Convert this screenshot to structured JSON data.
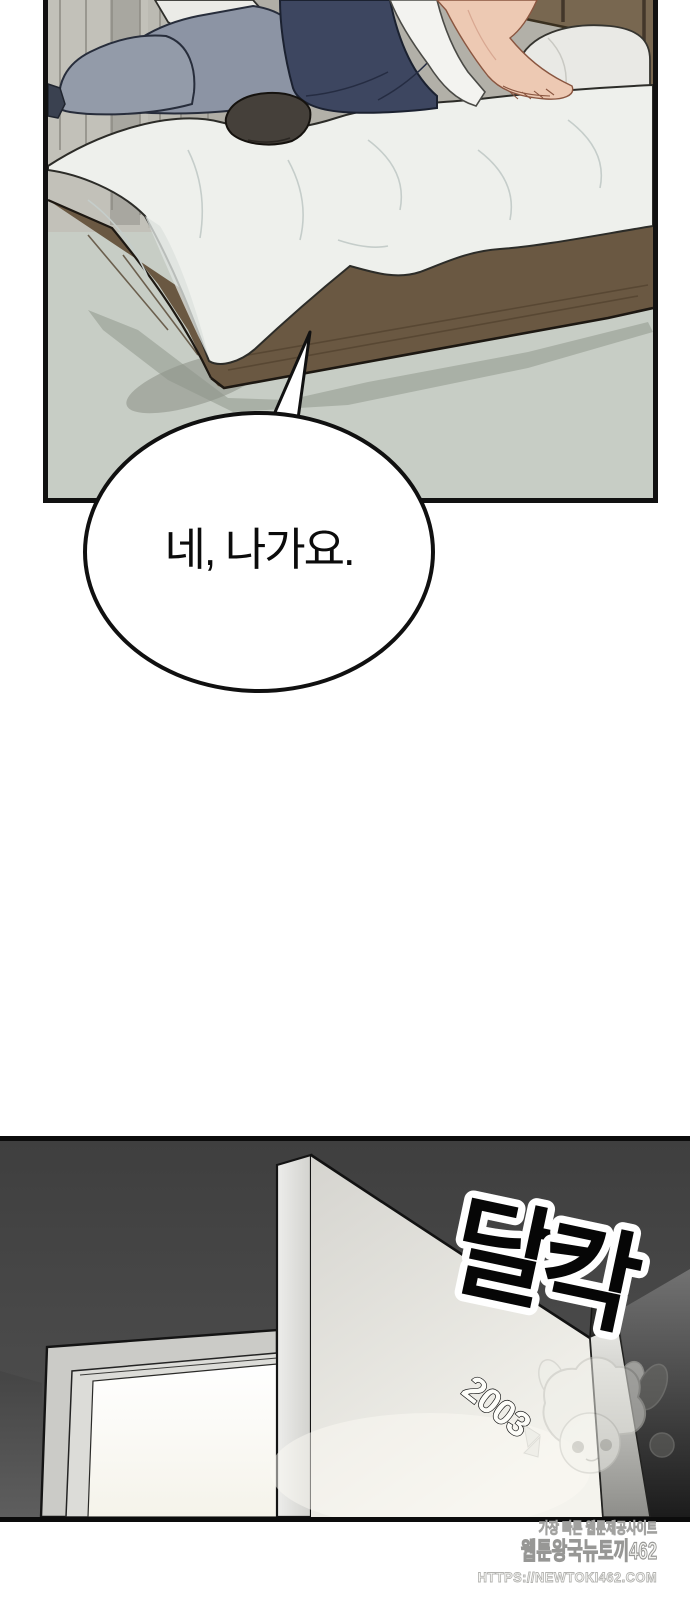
{
  "page": {
    "width": 690,
    "height": 1600,
    "background": "#ffffff"
  },
  "panel_bedroom": {
    "description": "bedroom scene, person sitting on bed",
    "colors": {
      "carpet": "#c7cdc5",
      "wall": "#b2b0a8",
      "curtain": "#c2c1b9",
      "pillow_blue": "#8c94a4",
      "pillow_white": "#ebebe7",
      "duvet": "#eef0ec",
      "bed_frame_wood": "#6a5842",
      "pants_navy": "#3d4660",
      "sock": "#45403a",
      "skin": "#edc9b3",
      "shirt": "#f3f3f0",
      "headboard": "#786750",
      "shadow": "#9fa59b",
      "border": "#111111"
    }
  },
  "speech_bubble": {
    "text": "네, 나가요."
  },
  "panel_hallway": {
    "description": "dark hallway, door opening with light",
    "colors": {
      "background": "#454545",
      "door_face": "#eceae5",
      "doorway_light": "#fbfaf5",
      "door_frame": "#cbcbc7",
      "border": "#0c0c0c"
    }
  },
  "sfx": {
    "full": "달칵",
    "char1": "달",
    "char2": "칵"
  },
  "door": {
    "room_number": "2003"
  },
  "watermark": {
    "line1": "가장 빠른 웹툰제공사이트",
    "line2": "웹툰왕국뉴토끼462",
    "line3": "HTTPS://NEWTOKI462.COM"
  }
}
